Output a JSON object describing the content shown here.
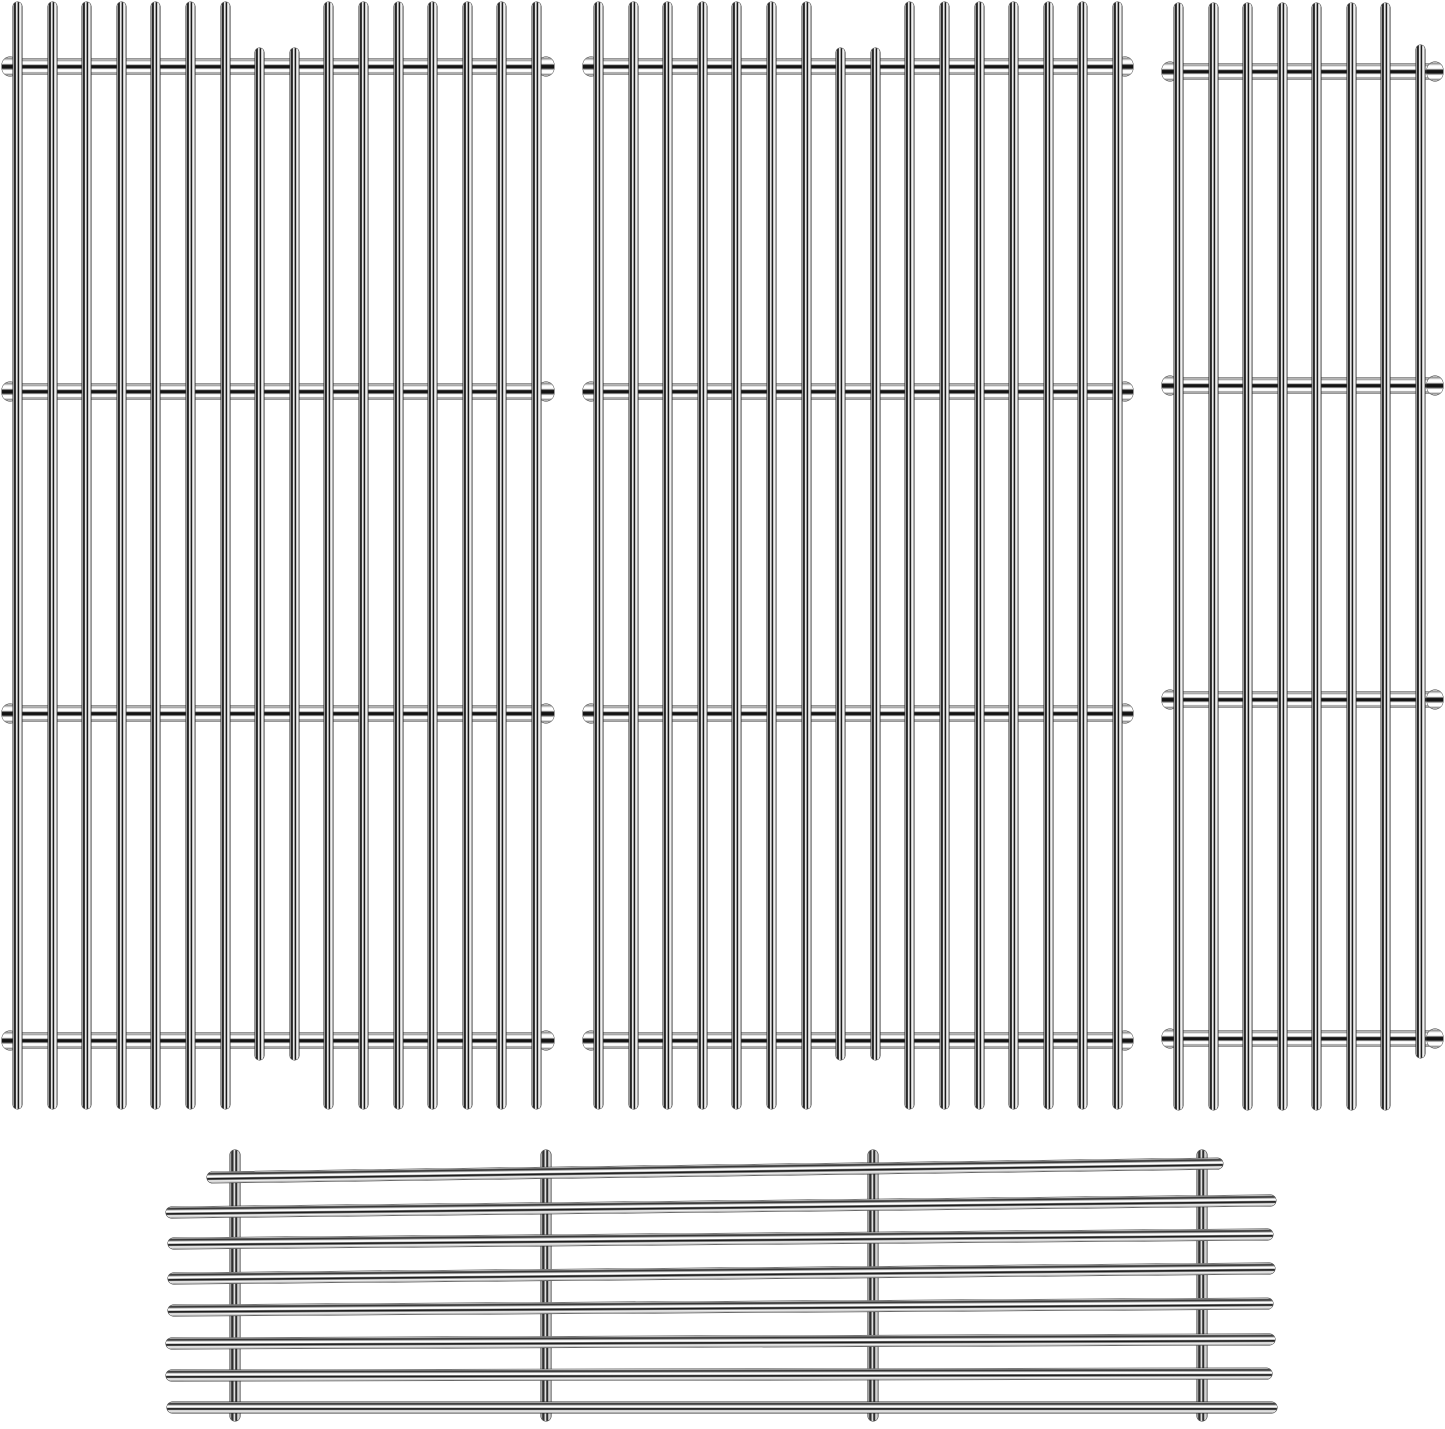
{
  "meta": {
    "description": "Product photo on a white background: four polished stainless steel grill replacement grates - two wide vertical-rod cooking grids, one narrow vertical-rod cooking grid, and one horizontal-rod warming rack below",
    "background": "#ffffff",
    "canvas_width": 1445,
    "canvas_height": 1429
  },
  "finish": {
    "material": "polished stainless steel",
    "chrome_dark": "#141414",
    "chrome_mid": "#8f8f8f",
    "chrome_light": "#ffffff",
    "outline": "#2f2f2f"
  },
  "grates": [
    {
      "name": "cooking-grate-left",
      "orientation": "vertical",
      "rod_width": 9,
      "rod_top": 2,
      "rod_bottom": 1109,
      "rod_xs": [
        17,
        52,
        86,
        121,
        155,
        190,
        225,
        259,
        294,
        328,
        363,
        398,
        432,
        467,
        501,
        536
      ],
      "short_rod_indices": [
        7,
        8
      ],
      "short_rod_top": 48,
      "short_rod_bottom": 1060,
      "crossbar_ys": [
        66,
        391,
        713,
        1040
      ],
      "crossbar_x": 3,
      "crossbar_width": 550,
      "crossbar_height": 15
    },
    {
      "name": "cooking-grate-middle",
      "orientation": "vertical",
      "rod_width": 9,
      "rod_top": 2,
      "rod_bottom": 1109,
      "rod_xs": [
        598,
        633,
        667,
        702,
        736,
        771,
        806,
        840,
        875,
        909,
        944,
        979,
        1013,
        1048,
        1082,
        1117
      ],
      "short_rod_indices": [
        7,
        8
      ],
      "short_rod_top": 48,
      "short_rod_bottom": 1060,
      "crossbar_ys": [
        66,
        391,
        713,
        1040
      ],
      "crossbar_x": 584,
      "crossbar_width": 548,
      "crossbar_height": 15
    },
    {
      "name": "cooking-grate-right",
      "orientation": "vertical",
      "rod_width": 9,
      "rod_top": 3,
      "rod_bottom": 1110,
      "rod_xs": [
        1178,
        1213,
        1247,
        1282,
        1316,
        1351,
        1385,
        1420
      ],
      "short_rod_indices": [
        7
      ],
      "short_rod_top": 45,
      "short_rod_bottom": 1058,
      "crossbar_ys": [
        71,
        385,
        699,
        1038
      ],
      "crossbar_x": 1163,
      "crossbar_width": 279,
      "crossbar_height": 15
    },
    {
      "name": "warming-rack",
      "orientation": "horizontal",
      "support_width": 10,
      "support_top": 1150,
      "support_bottom": 1421,
      "support_xs": [
        235,
        546,
        873,
        1202
      ],
      "rod_height": 11,
      "rods": [
        {
          "x1": 207,
          "x2": 1223,
          "y": 1177,
          "tilt": -0.79
        },
        {
          "x1": 166,
          "x2": 1276,
          "y": 1212,
          "tilt": -0.62
        },
        {
          "x1": 168,
          "x2": 1273,
          "y": 1243,
          "tilt": -0.47
        },
        {
          "x1": 168,
          "x2": 1275,
          "y": 1278,
          "tilt": -0.52
        },
        {
          "x1": 168,
          "x2": 1273,
          "y": 1310,
          "tilt": -0.36
        },
        {
          "x1": 166,
          "x2": 1275,
          "y": 1343,
          "tilt": -0.21
        },
        {
          "x1": 166,
          "x2": 1272,
          "y": 1375,
          "tilt": -0.1
        },
        {
          "x1": 167,
          "x2": 1277,
          "y": 1407,
          "tilt": 0
        }
      ]
    }
  ]
}
